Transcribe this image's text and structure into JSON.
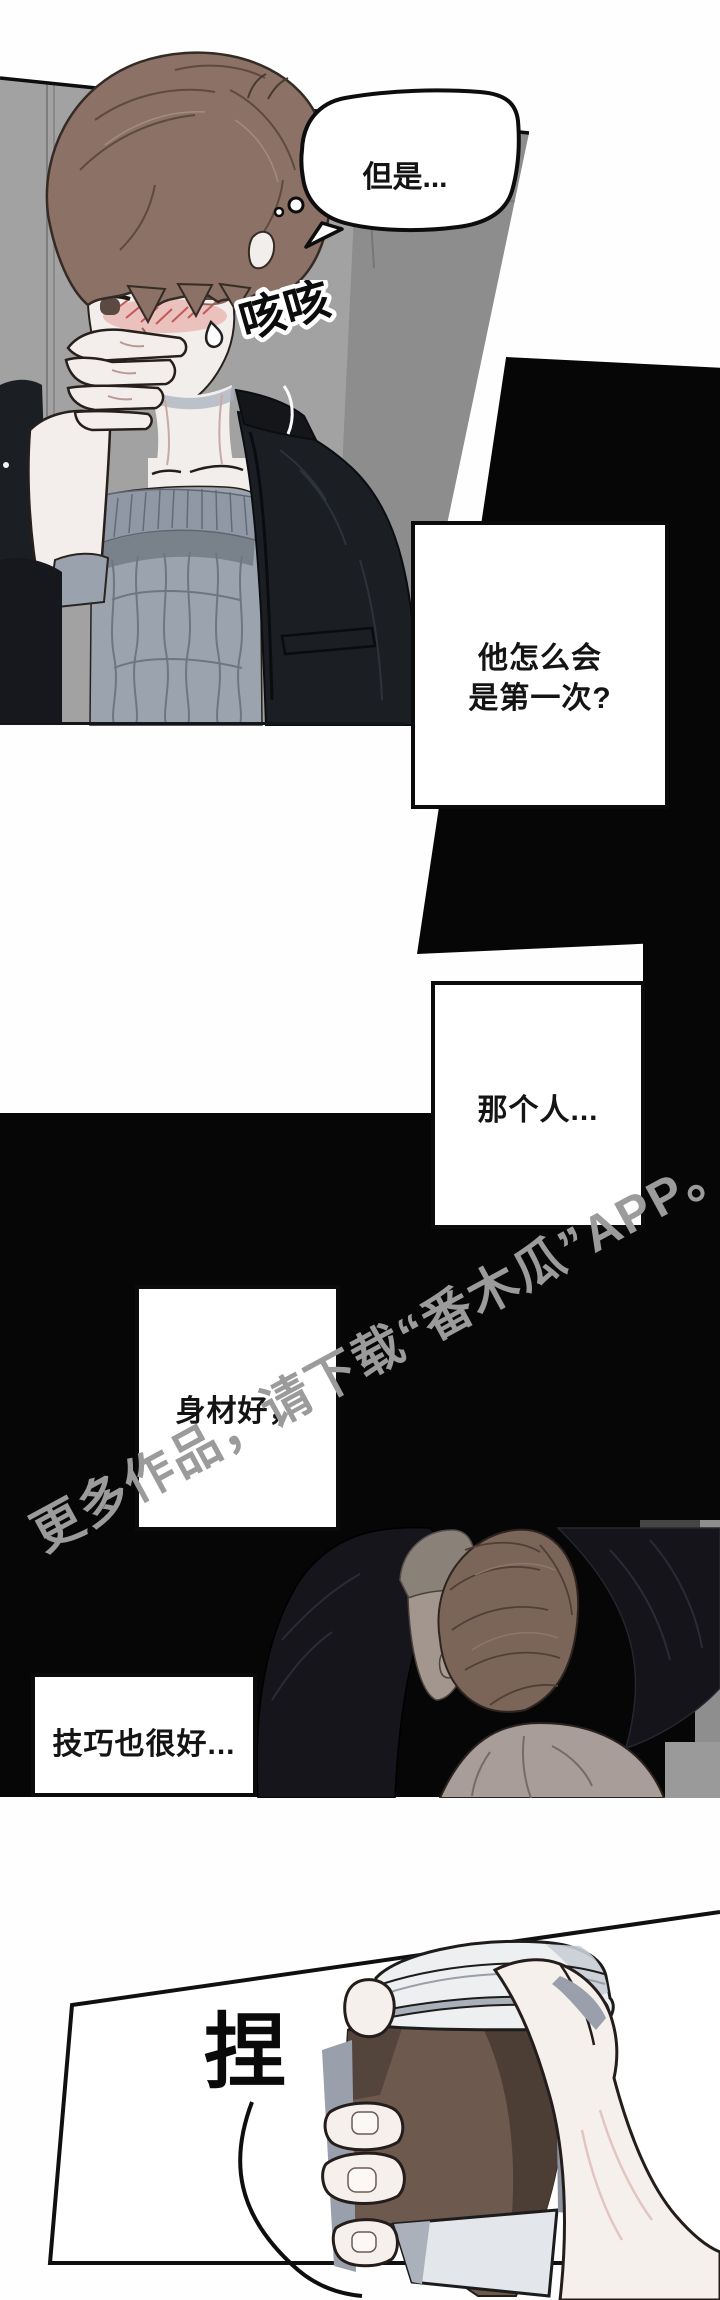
{
  "panel1": {
    "speech_bubble_text": "但是...",
    "cough_sfx": "咳咳"
  },
  "narration": {
    "box1_line1": "他怎么会",
    "box1_line2": "是第一次?",
    "box2": "那个人...",
    "box3": "身材好，",
    "box4": "技巧也很好..."
  },
  "panel5": {
    "pinch_sfx": "捏"
  },
  "watermark": {
    "text": "更多作品，请下载“番木瓜”APP。",
    "color": "#9b9b9b"
  }
}
